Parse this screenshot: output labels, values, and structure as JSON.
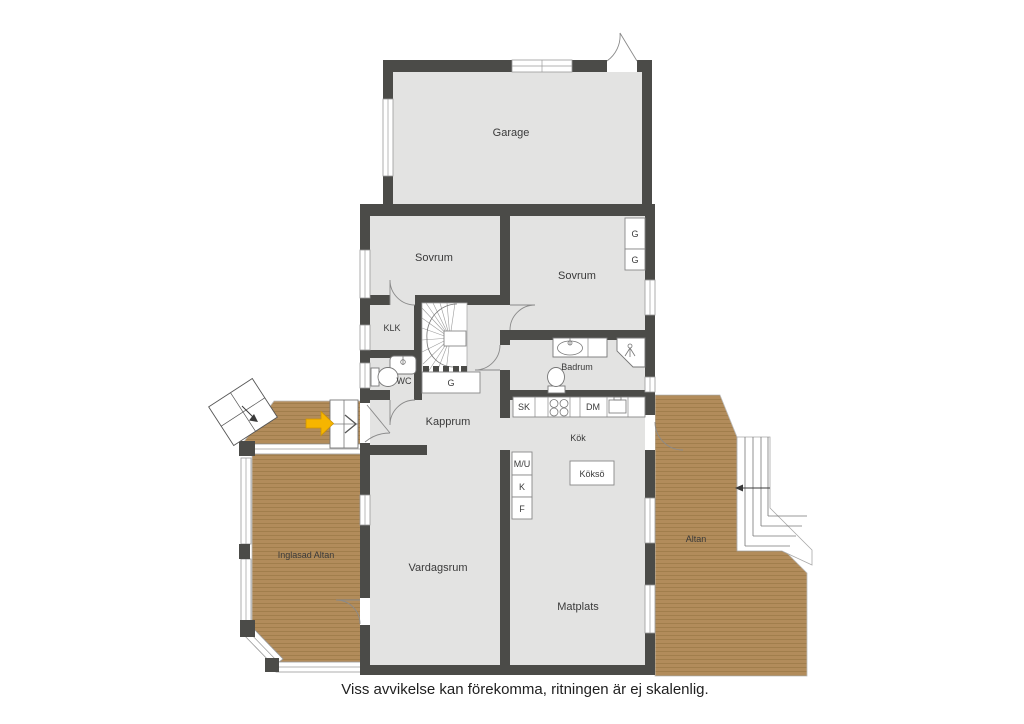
{
  "plan": {
    "caption": "Viss avvikelse kan förekomma, ritningen är ej skalenlig.",
    "labels": {
      "garage": "Garage",
      "sovrum_left": "Sovrum",
      "sovrum_right": "Sovrum",
      "klk": "KLK",
      "wc": "WC",
      "kapprum": "Kapprum",
      "badrum": "Badrum",
      "kok": "Kök",
      "kokso": "Köksö",
      "vardagsrum": "Vardagsrum",
      "matplats": "Matplats",
      "inglasad_altan": "Inglasad Altan",
      "altan": "Altan",
      "g1": "G",
      "g2": "G",
      "g_understairs": "G",
      "sk": "SK",
      "dm": "DM",
      "mu": "M/U",
      "k": "K",
      "f": "F"
    },
    "colors": {
      "wall": "#4b4b48",
      "floor": "#e3e3e2",
      "deck": "#b28c5b",
      "deck_line": "#9c7947",
      "window_line": "#9a9a9a",
      "arrow": "#f6b500",
      "text": "#3a3a3a"
    }
  }
}
